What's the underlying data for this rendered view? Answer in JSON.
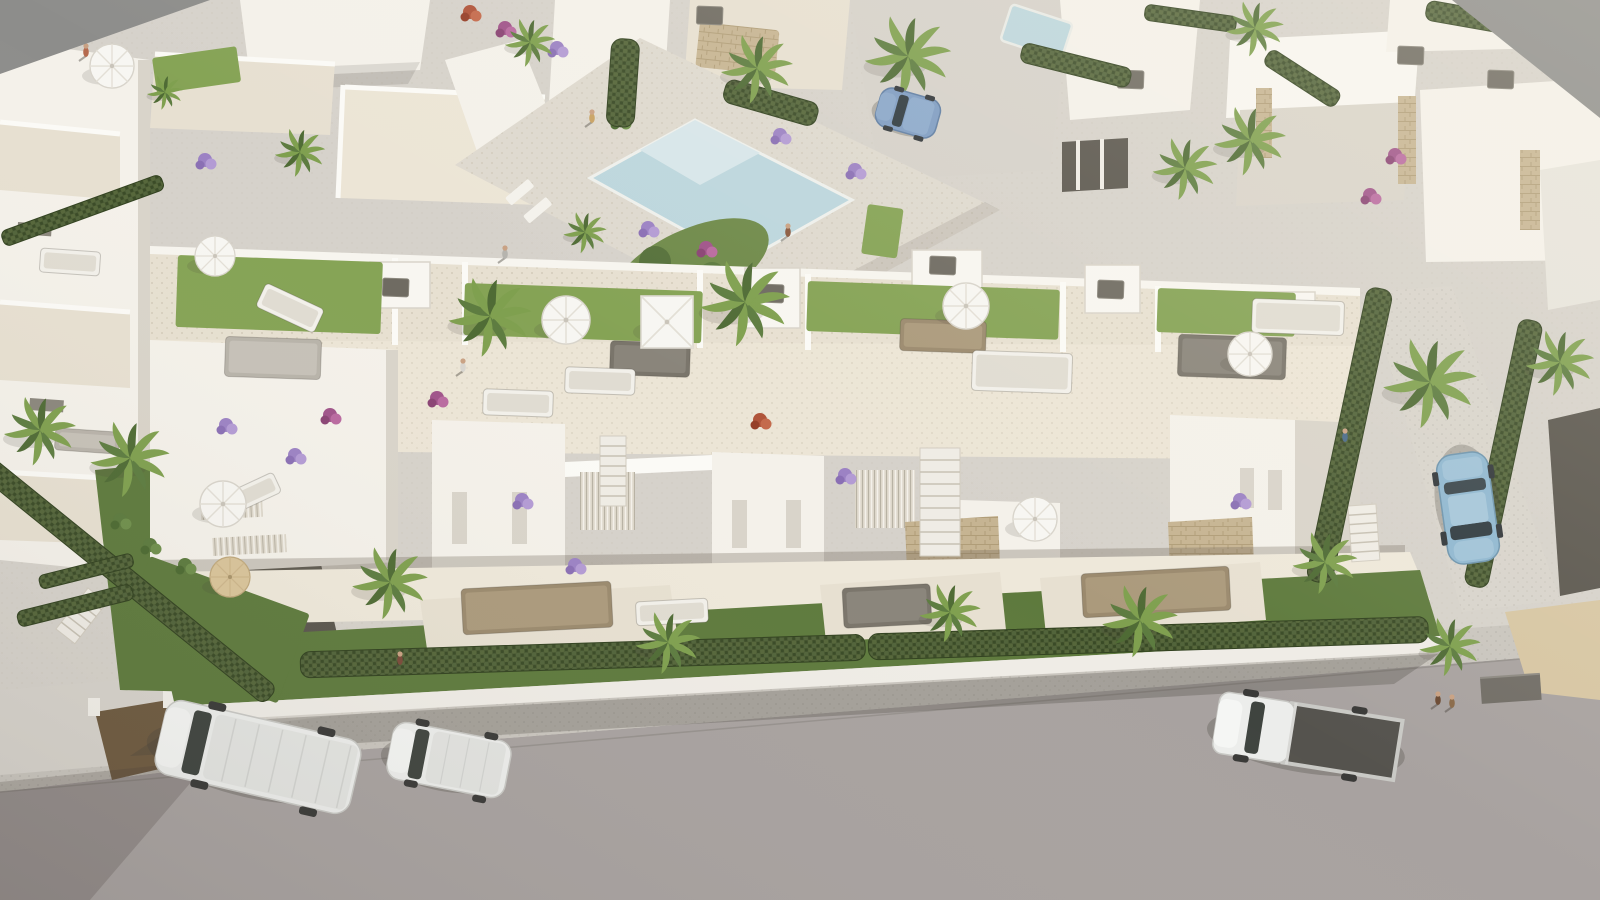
{
  "meta": {
    "title": "Aerial 3D architectural rendering of a white residential complex with rooftop terraces, pool courtyard, palm trees and a street with parked vehicles"
  },
  "scene": {
    "canvas": {
      "w": 1600,
      "h": 900
    },
    "palette": {
      "bg": "#d6d2cb",
      "gray_corner": "#8d8d8b",
      "road": "#a8a2a0",
      "sidewalk": "#c9c5be",
      "wall": "#efece6",
      "building": "#f4f1ea",
      "building_shade": "#d9d4ca",
      "terrace": "#e7e0d1",
      "terrace2": "#ece5d6",
      "lawn_bright": "#85a355",
      "lawn_dark": "#5e7a3d",
      "hedge": "#46552f",
      "pool": "#bcd6dd",
      "pool_steps": "#d7e6ea",
      "stone": "#c6b492",
      "wood": "#9b8a6e",
      "sand": "#d7c6a3",
      "path_brown": "#6e5a40",
      "gravel_dark": "#5a564e",
      "car_white": "#ecedeb",
      "car_blue": "#8fb7d0",
      "car_steel": "#7e9cc2",
      "bed_dark": "#55534e",
      "shadow": "rgba(70,64,56,0.28)"
    },
    "lawns": [
      [
        178,
        255,
        205,
        72,
        2,
        "bright"
      ],
      [
        465,
        283,
        238,
        52,
        2,
        "bright"
      ],
      [
        808,
        281,
        252,
        50,
        2,
        "bright"
      ],
      [
        1158,
        288,
        138,
        44,
        2,
        "bright"
      ],
      [
        152,
        58,
        85,
        36,
        -8,
        "bright"
      ],
      [
        868,
        204,
        36,
        50,
        8,
        "bright"
      ],
      [
        150,
        556,
        170,
        95,
        20,
        "dark"
      ]
    ],
    "hedges": [
      [
        300,
        652,
        565,
        26,
        -1.8
      ],
      [
        868,
        634,
        560,
        26,
        -1.8
      ],
      [
        -10,
        455,
        370,
        22,
        39
      ],
      [
        0,
        232,
        170,
        16,
        -20
      ],
      [
        612,
        38,
        28,
        88,
        4
      ],
      [
        728,
        78,
        96,
        24,
        16
      ],
      [
        1024,
        42,
        112,
        20,
        14
      ],
      [
        1272,
        48,
        84,
        18,
        33
      ],
      [
        1428,
        0,
        130,
        20,
        10
      ],
      [
        1146,
        4,
        92,
        16,
        8
      ],
      [
        1368,
        286,
        26,
        300,
        12
      ],
      [
        1520,
        318,
        24,
        272,
        12
      ],
      [
        16,
        612,
        118,
        16,
        -14
      ],
      [
        38,
        576,
        96,
        14,
        -14
      ]
    ],
    "palms": [
      [
        300,
        152,
        0.7
      ],
      [
        530,
        42,
        0.7
      ],
      [
        757,
        68,
        1.0
      ],
      [
        908,
        56,
        1.2
      ],
      [
        1185,
        168,
        0.9
      ],
      [
        1255,
        28,
        0.8
      ],
      [
        1250,
        140,
        1.0
      ],
      [
        40,
        430,
        1.0
      ],
      [
        130,
        458,
        1.1
      ],
      [
        165,
        92,
        0.5
      ],
      [
        490,
        316,
        1.15
      ],
      [
        745,
        302,
        1.25
      ],
      [
        585,
        232,
        0.6
      ],
      [
        390,
        582,
        1.05
      ],
      [
        668,
        642,
        0.9
      ],
      [
        950,
        612,
        0.85
      ],
      [
        1140,
        620,
        1.05
      ],
      [
        1325,
        562,
        0.9
      ],
      [
        1450,
        646,
        0.85
      ],
      [
        1430,
        382,
        1.3
      ],
      [
        1560,
        362,
        0.95
      ]
    ],
    "umbrellas": [
      [
        112,
        66,
        22,
        "white"
      ],
      [
        215,
        256,
        20,
        "white"
      ],
      [
        566,
        320,
        24,
        "white"
      ],
      [
        966,
        306,
        23,
        "white"
      ],
      [
        1250,
        354,
        22,
        "white"
      ],
      [
        223,
        504,
        23,
        "white"
      ],
      [
        230,
        577,
        20,
        "tan"
      ],
      [
        1035,
        519,
        22,
        "white"
      ],
      [
        667,
        322,
        26,
        "square"
      ]
    ],
    "furniture": [
      [
        225,
        338,
        96,
        40,
        2,
        "gray"
      ],
      [
        258,
        295,
        64,
        26,
        25,
        "white"
      ],
      [
        610,
        342,
        80,
        34,
        2,
        "dark"
      ],
      [
        565,
        368,
        70,
        26,
        2,
        "white"
      ],
      [
        483,
        390,
        70,
        26,
        2,
        "white"
      ],
      [
        900,
        320,
        86,
        32,
        2,
        "wood"
      ],
      [
        972,
        352,
        100,
        40,
        2,
        "white"
      ],
      [
        1178,
        336,
        108,
        42,
        2,
        "dark"
      ],
      [
        1252,
        300,
        92,
        34,
        2,
        "white"
      ],
      [
        462,
        585,
        150,
        46,
        -3,
        "wood"
      ],
      [
        1082,
        570,
        148,
        44,
        -3,
        "wood"
      ],
      [
        843,
        586,
        88,
        40,
        -3,
        "dark"
      ],
      [
        636,
        600,
        72,
        24,
        -3,
        "white"
      ],
      [
        218,
        484,
        62,
        22,
        -25,
        "white"
      ],
      [
        40,
        250,
        60,
        24,
        4,
        "white"
      ],
      [
        55,
        430,
        64,
        22,
        4,
        "gray"
      ]
    ],
    "flowers": [
      [
        505,
        28,
        "magenta"
      ],
      [
        557,
        48,
        "purple"
      ],
      [
        648,
        228,
        "purple"
      ],
      [
        706,
        248,
        "magenta"
      ],
      [
        855,
        170,
        "purple"
      ],
      [
        780,
        135,
        "purple"
      ],
      [
        330,
        415,
        "magenta"
      ],
      [
        295,
        455,
        "purple"
      ],
      [
        522,
        500,
        "purple"
      ],
      [
        845,
        475,
        "purple"
      ],
      [
        1240,
        500,
        "purple"
      ],
      [
        1395,
        155,
        "magenta"
      ],
      [
        1370,
        195,
        "magenta"
      ],
      [
        205,
        160,
        "purple"
      ],
      [
        226,
        425,
        "purple"
      ],
      [
        575,
        565,
        "purple"
      ],
      [
        760,
        420,
        "red"
      ],
      [
        437,
        398,
        "magenta"
      ],
      [
        470,
        12,
        "red"
      ],
      [
        150,
        545,
        "green"
      ],
      [
        185,
        565,
        "green"
      ],
      [
        120,
        520,
        "green"
      ],
      [
        620,
        120,
        "green"
      ]
    ],
    "people": [
      [
        86,
        50,
        "#b56a4e"
      ],
      [
        592,
        116,
        "#c8a263"
      ],
      [
        788,
        230,
        "#8a5a40"
      ],
      [
        505,
        252,
        "#b5b3ae"
      ],
      [
        463,
        365,
        "#d8d5cf"
      ],
      [
        1345,
        435,
        "#4a6b8a"
      ],
      [
        400,
        658,
        "#7a4a3a"
      ],
      [
        1438,
        698,
        "#6b4a33"
      ],
      [
        1452,
        701,
        "#8a6a4a"
      ]
    ],
    "vents": [
      [
        383,
        278
      ],
      [
        758,
        284
      ],
      [
        930,
        256
      ],
      [
        1098,
        280
      ],
      [
        1268,
        302
      ],
      [
        1398,
        46
      ],
      [
        1488,
        70
      ],
      [
        1118,
        70
      ],
      [
        697,
        6
      ]
    ],
    "stairs": [
      [
        600,
        436,
        26,
        70,
        0,
        7
      ],
      [
        920,
        448,
        40,
        108,
        0,
        9
      ],
      [
        1348,
        506,
        28,
        56,
        -4,
        6
      ],
      [
        88,
        588,
        24,
        52,
        38,
        6
      ]
    ],
    "ramps": [
      [
        1480,
        678,
        60,
        26,
        -4
      ]
    ],
    "vehicles": [
      [
        "van",
        258,
        757,
        13
      ],
      [
        "caddy",
        449,
        760,
        11
      ],
      [
        "pickup",
        1307,
        736,
        9
      ],
      [
        "sedan",
        1468,
        508,
        172
      ],
      [
        "hatch",
        908,
        113,
        16
      ]
    ]
  }
}
